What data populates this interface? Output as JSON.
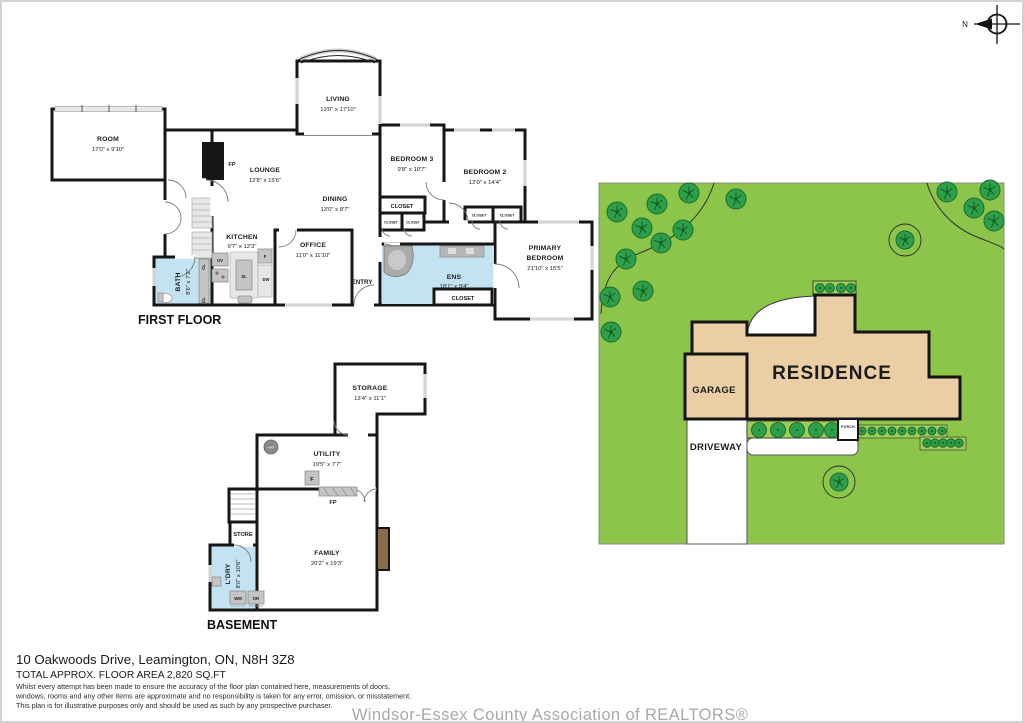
{
  "compass": {
    "north": "N"
  },
  "first_floor": {
    "title": "FIRST FLOOR",
    "rooms": {
      "room": {
        "name": "ROOM",
        "dims": "17'0\" x 9'10\""
      },
      "living": {
        "name": "LIVING",
        "dims": "13'0\" x 17'10\""
      },
      "lounge": {
        "name": "LOUNGE",
        "dims": "12'8\" x 15'6\""
      },
      "dining": {
        "name": "DINING",
        "dims": "13'0\" x 8'7\""
      },
      "kitchen": {
        "name": "KITCHEN",
        "dims": "9'7\" x 12'3\""
      },
      "office": {
        "name": "OFFICE",
        "dims": "11'0\" x 11'10\""
      },
      "bedroom3": {
        "name": "BEDROOM 3",
        "dims": "9'8\" x 10'7\""
      },
      "bedroom2": {
        "name": "BEDROOM 2",
        "dims": "12'0\" x 14'4\""
      },
      "primary": {
        "line1": "PRIMARY",
        "line2": "BEDROOM",
        "dims": "21'10\" x 15'5\""
      },
      "ens": {
        "name": "ENS",
        "dims": "18'1\" x 9'4\""
      },
      "bath": {
        "name": "BATH",
        "dims": "8'6\" x 7'2\""
      }
    },
    "tags": {
      "fp": "FP",
      "entry": "ENTRY",
      "ov": "OV",
      "sl": "SL",
      "f": "F",
      "dw": "DW",
      "cl": "CL",
      "closet": "CLOSET"
    }
  },
  "basement": {
    "title": "BASEMENT",
    "rooms": {
      "storage": {
        "name": "STORAGE",
        "dims": "13'4\" x 11'1\""
      },
      "utility": {
        "name": "UTILITY",
        "dims": "19'5\" x 7'7\""
      },
      "family": {
        "name": "FAMILY",
        "dims": "20'2\" x 19'3\""
      },
      "laundry": {
        "name": "L'DRY",
        "dims": "8'0\" x 10'6\""
      }
    },
    "tags": {
      "store": "STORE",
      "f": "F",
      "fp": "FP",
      "wm": "WM",
      "dr": "DR",
      "hwt": "HWT"
    }
  },
  "site_plan": {
    "residence": "RESIDENCE",
    "garage": "GARAGE",
    "driveway": "DRIVEWAY",
    "porch": "PORCH"
  },
  "footer": {
    "address": "10 Oakwoods Drive, Leamington, ON, N8H 3Z8",
    "area": "TOTAL APPROX. FLOOR AREA 2,820 SQ.FT",
    "disclaimer1": "Whilst every attempt has been made to ensure the accuracy of the floor plan contained here, measurements of doors,",
    "disclaimer2": "windows, rooms and any other items are approximate and no responsibility is taken for any error, omission, or misstatement.",
    "disclaimer3": "This plan is for illustrative purposes only and should be used as such by any prospective purchaser.",
    "watermark": "Windsor-Essex County Association of REALTORS®"
  }
}
